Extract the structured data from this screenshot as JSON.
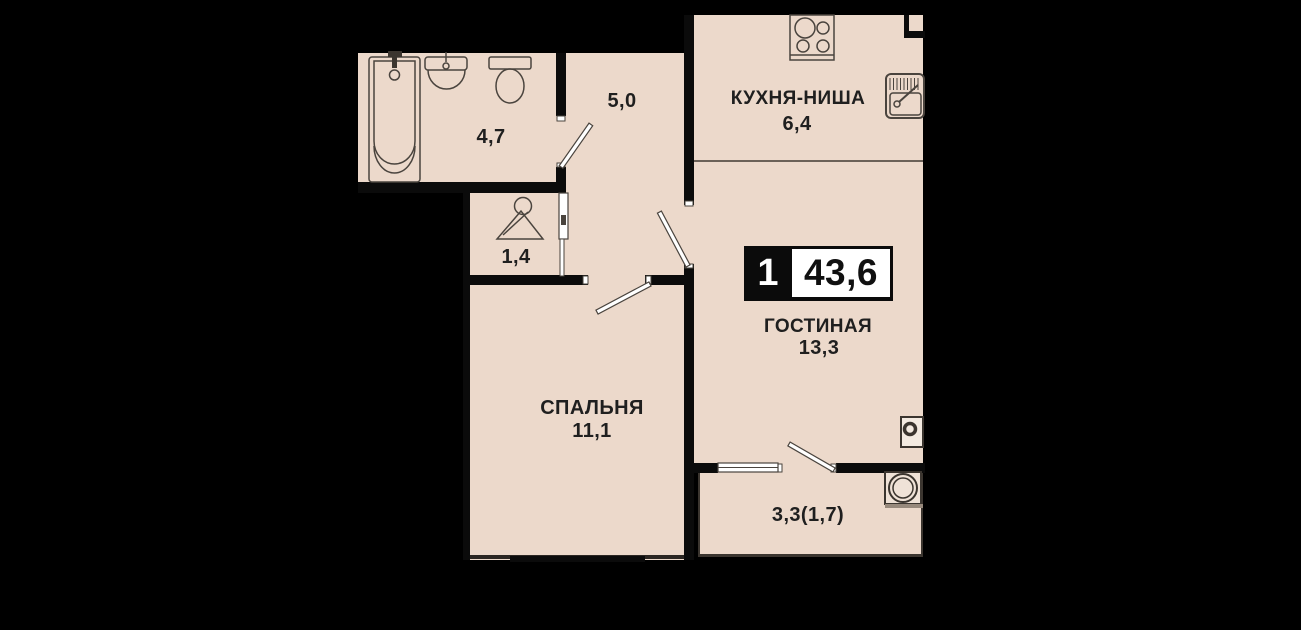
{
  "floor_plan": {
    "summary_badge": {
      "rooms_count": "1",
      "total_area": "43,6"
    },
    "rooms": {
      "kitchen": {
        "label": "КУХНЯ-НИША",
        "area": "6,4"
      },
      "living": {
        "label": "ГОСТИНАЯ",
        "area": "13,3"
      },
      "bedroom": {
        "label": "СПАЛЬНЯ",
        "area": "11,1"
      },
      "hallway": {
        "area": "5,0"
      },
      "bathroom": {
        "area": "4,7"
      },
      "closet": {
        "area": "1,4"
      },
      "balcony": {
        "area": "3,3(1,7)"
      }
    },
    "icons": [
      "bathtub-icon",
      "washbasin-icon",
      "toilet-icon",
      "hanger-icon",
      "stove-icon",
      "kitchen-sink-icon",
      "electric-panel-icon",
      "washing-machine-icon",
      "balcony-window-icon"
    ],
    "colors": {
      "background": "#000000",
      "floor": "#ECD9CB",
      "wall": "#0B0B0B",
      "outline": "#4A443E",
      "text": "#1F1F1F",
      "badge_box": "#FFFFFF"
    }
  }
}
